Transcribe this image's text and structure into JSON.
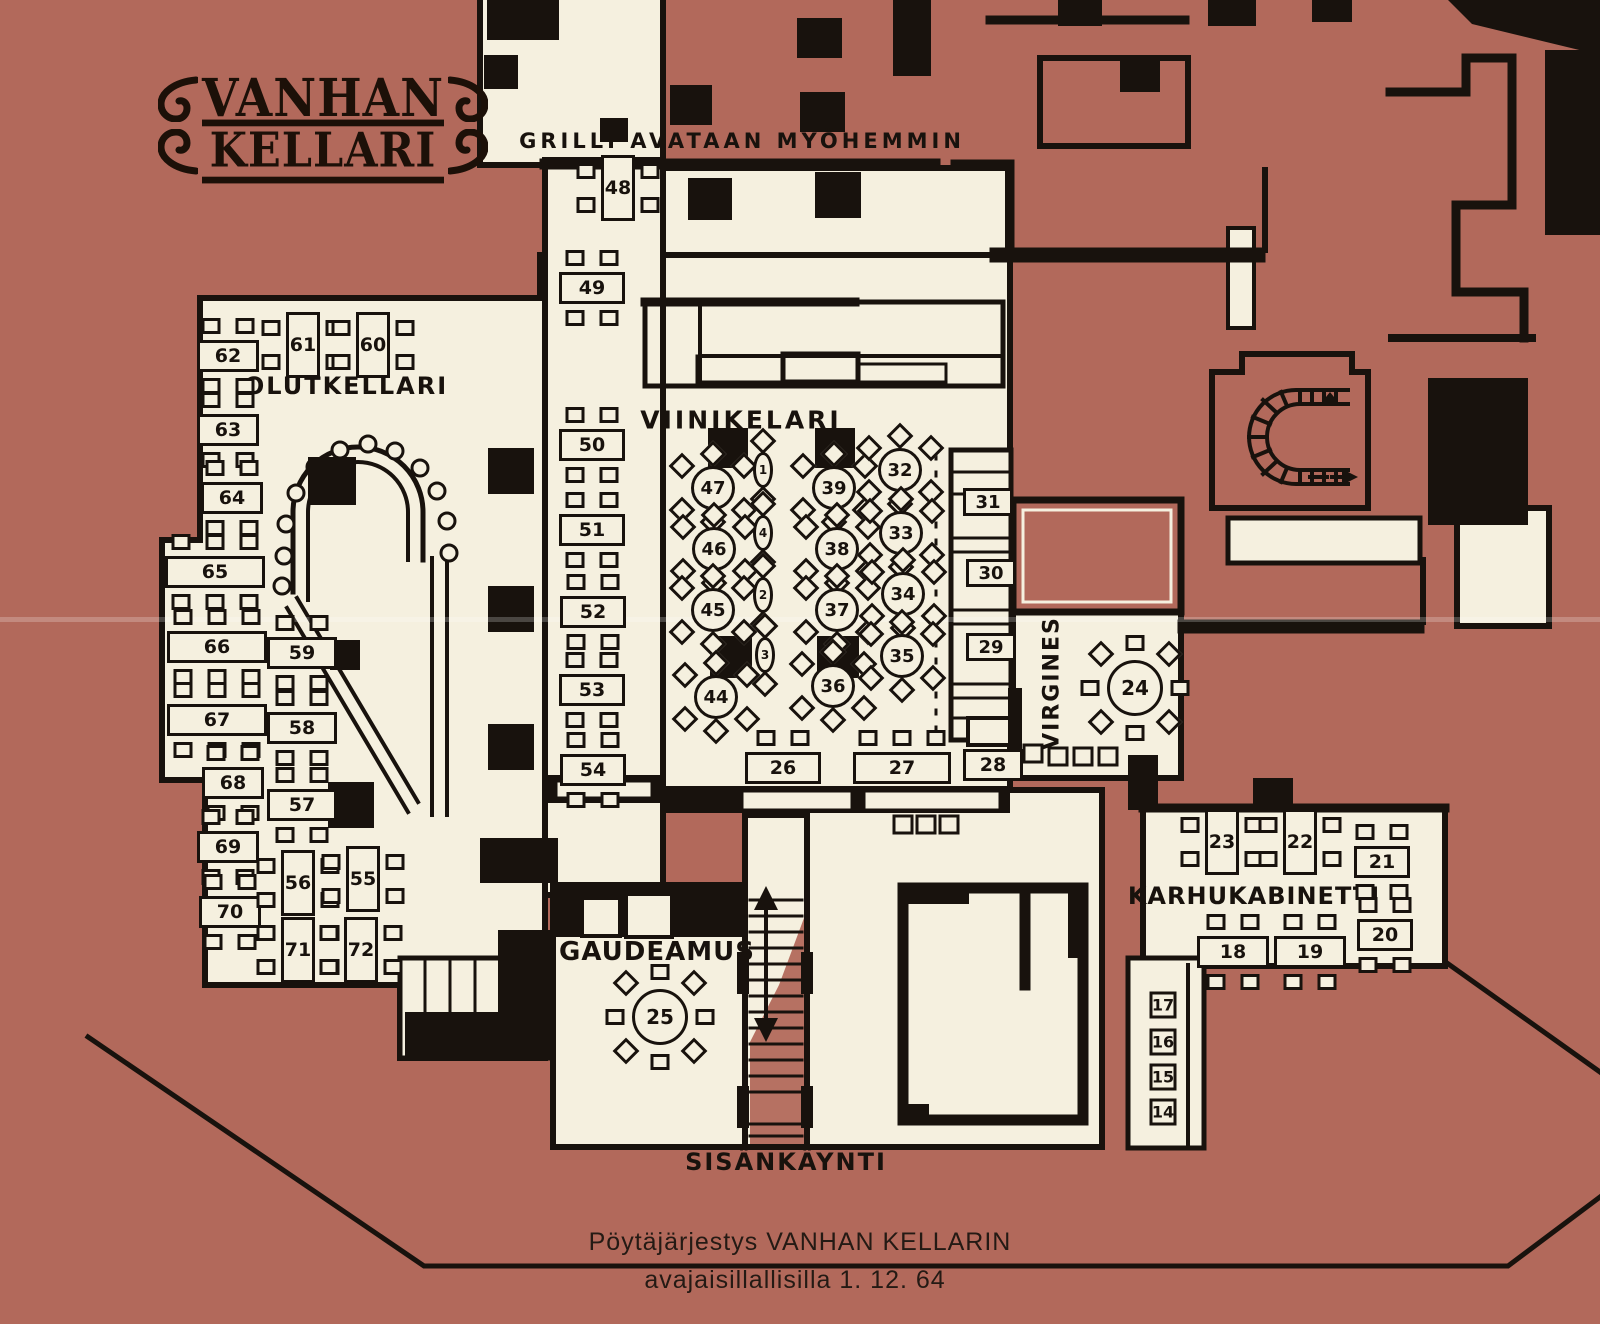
{
  "logo": {
    "line1": "VANHAN",
    "line2": "KELLARI"
  },
  "colors": {
    "background": "#b2695b",
    "floor": "#f5f0df",
    "ink": "#18120d"
  },
  "rooms": [
    {
      "id": "grilli-note",
      "text": "GRILLI AVATAAN MYÖHEMMIN",
      "x": 742,
      "y": 141,
      "size": 21,
      "spacing": 4,
      "rot": 0
    },
    {
      "id": "olutkellari",
      "text": "OLUTKELLARI",
      "x": 346,
      "y": 386,
      "size": 24,
      "spacing": 2,
      "rot": 0
    },
    {
      "id": "viinikelari",
      "text": "VIINIKELARI",
      "x": 741,
      "y": 420,
      "size": 25,
      "spacing": 3,
      "rot": 0
    },
    {
      "id": "virgines",
      "text": "VIRGINES",
      "x": 1052,
      "y": 683,
      "size": 22,
      "spacing": 2,
      "rot": -90
    },
    {
      "id": "karhukabinetti",
      "text": "KARHUKABINETTI",
      "x": 1254,
      "y": 896,
      "size": 24,
      "spacing": 1,
      "rot": 0
    },
    {
      "id": "gaudeamus",
      "text": "GAUDEAMUS",
      "x": 657,
      "y": 952,
      "size": 26,
      "spacing": 1,
      "rot": 0
    },
    {
      "id": "sisankaynti",
      "text": "SISÄNKÄYNTI",
      "x": 786,
      "y": 1162,
      "size": 24,
      "spacing": 2,
      "rot": 0
    }
  ],
  "caption": {
    "line1": "Pöytäjärjestys VANHAN KELLARIN",
    "line2": "avajaisillallisilla 1. 12. 64"
  },
  "tables": [
    {
      "n": "62",
      "x": 228,
      "y": 356,
      "t": "h",
      "w": 62
    },
    {
      "n": "63",
      "x": 228,
      "y": 430,
      "t": "h",
      "w": 62
    },
    {
      "n": "64",
      "x": 232,
      "y": 498,
      "t": "h",
      "w": 62
    },
    {
      "n": "65",
      "x": 215,
      "y": 572,
      "t": "h",
      "w": 100,
      "ct": 3,
      "cb": 3
    },
    {
      "n": "66",
      "x": 217,
      "y": 647,
      "t": "h",
      "w": 100,
      "ct": 3,
      "cb": 3
    },
    {
      "n": "67",
      "x": 217,
      "y": 720,
      "t": "h",
      "w": 100,
      "ct": 3,
      "cb": 3
    },
    {
      "n": "68",
      "x": 233,
      "y": 783,
      "t": "h",
      "w": 62
    },
    {
      "n": "69",
      "x": 228,
      "y": 847,
      "t": "h",
      "w": 62
    },
    {
      "n": "70",
      "x": 230,
      "y": 912,
      "t": "h",
      "w": 62
    },
    {
      "n": "61",
      "x": 303,
      "y": 345,
      "t": "v"
    },
    {
      "n": "60",
      "x": 373,
      "y": 345,
      "t": "v"
    },
    {
      "n": "59",
      "x": 302,
      "y": 653,
      "t": "h",
      "w": 70
    },
    {
      "n": "58",
      "x": 302,
      "y": 728,
      "t": "h",
      "w": 70
    },
    {
      "n": "57",
      "x": 302,
      "y": 805,
      "t": "h",
      "w": 70
    },
    {
      "n": "56",
      "x": 298,
      "y": 883,
      "t": "v"
    },
    {
      "n": "55",
      "x": 363,
      "y": 879,
      "t": "v"
    },
    {
      "n": "71",
      "x": 298,
      "y": 950,
      "t": "v"
    },
    {
      "n": "72",
      "x": 361,
      "y": 950,
      "t": "v"
    },
    {
      "n": "48",
      "x": 618,
      "y": 188,
      "t": "v"
    },
    {
      "n": "49",
      "x": 592,
      "y": 288,
      "t": "h",
      "w": 66
    },
    {
      "n": "50",
      "x": 592,
      "y": 445,
      "t": "h",
      "w": 66
    },
    {
      "n": "51",
      "x": 592,
      "y": 530,
      "t": "h",
      "w": 66
    },
    {
      "n": "52",
      "x": 593,
      "y": 612,
      "t": "h",
      "w": 66
    },
    {
      "n": "53",
      "x": 592,
      "y": 690,
      "t": "h",
      "w": 66
    },
    {
      "n": "54",
      "x": 593,
      "y": 770,
      "t": "h",
      "w": 66
    },
    {
      "n": "47",
      "x": 713,
      "y": 488,
      "t": "r"
    },
    {
      "n": "46",
      "x": 714,
      "y": 549,
      "t": "r"
    },
    {
      "n": "45",
      "x": 713,
      "y": 610,
      "t": "r"
    },
    {
      "n": "44",
      "x": 716,
      "y": 697,
      "t": "r"
    },
    {
      "n": "39",
      "x": 834,
      "y": 488,
      "t": "r"
    },
    {
      "n": "38",
      "x": 837,
      "y": 549,
      "t": "r"
    },
    {
      "n": "37",
      "x": 837,
      "y": 610,
      "t": "r"
    },
    {
      "n": "36",
      "x": 833,
      "y": 686,
      "t": "r"
    },
    {
      "n": "32",
      "x": 900,
      "y": 470,
      "t": "r"
    },
    {
      "n": "33",
      "x": 901,
      "y": 533,
      "t": "r"
    },
    {
      "n": "34",
      "x": 903,
      "y": 594,
      "t": "r"
    },
    {
      "n": "35",
      "x": 902,
      "y": 656,
      "t": "r"
    },
    {
      "n": "1",
      "x": 763,
      "y": 470,
      "t": "lens"
    },
    {
      "n": "4",
      "x": 763,
      "y": 533,
      "t": "lens"
    },
    {
      "n": "2",
      "x": 763,
      "y": 595,
      "t": "lens"
    },
    {
      "n": "3",
      "x": 765,
      "y": 655,
      "t": "lens"
    },
    {
      "n": "31",
      "x": 988,
      "y": 502,
      "t": "cell"
    },
    {
      "n": "30",
      "x": 991,
      "y": 573,
      "t": "cell"
    },
    {
      "n": "29",
      "x": 991,
      "y": 647,
      "t": "cell"
    },
    {
      "n": "26",
      "x": 783,
      "y": 768,
      "t": "h",
      "w": 76,
      "cb": 0
    },
    {
      "n": "27",
      "x": 902,
      "y": 768,
      "t": "h",
      "w": 98,
      "ct": 3,
      "cb": 0
    },
    {
      "n": "28",
      "x": 993,
      "y": 765,
      "t": "h",
      "w": 60,
      "ct": 0,
      "cb": 0
    },
    {
      "n": "24",
      "x": 1135,
      "y": 688,
      "t": "R"
    },
    {
      "n": "25",
      "x": 660,
      "y": 1017,
      "t": "R"
    },
    {
      "n": "23",
      "x": 1222,
      "y": 842,
      "t": "v"
    },
    {
      "n": "22",
      "x": 1300,
      "y": 842,
      "t": "v"
    },
    {
      "n": "21",
      "x": 1382,
      "y": 862,
      "t": "h",
      "w": 56
    },
    {
      "n": "20",
      "x": 1385,
      "y": 935,
      "t": "h",
      "w": 56
    },
    {
      "n": "18",
      "x": 1233,
      "y": 952,
      "t": "h",
      "w": 72
    },
    {
      "n": "19",
      "x": 1310,
      "y": 952,
      "t": "h",
      "w": 72
    },
    {
      "n": "17",
      "x": 1163,
      "y": 1005,
      "t": "sq"
    },
    {
      "n": "16",
      "x": 1163,
      "y": 1042,
      "t": "sq"
    },
    {
      "n": "15",
      "x": 1163,
      "y": 1077,
      "t": "sq"
    },
    {
      "n": "14",
      "x": 1163,
      "y": 1112,
      "t": "sq"
    }
  ]
}
